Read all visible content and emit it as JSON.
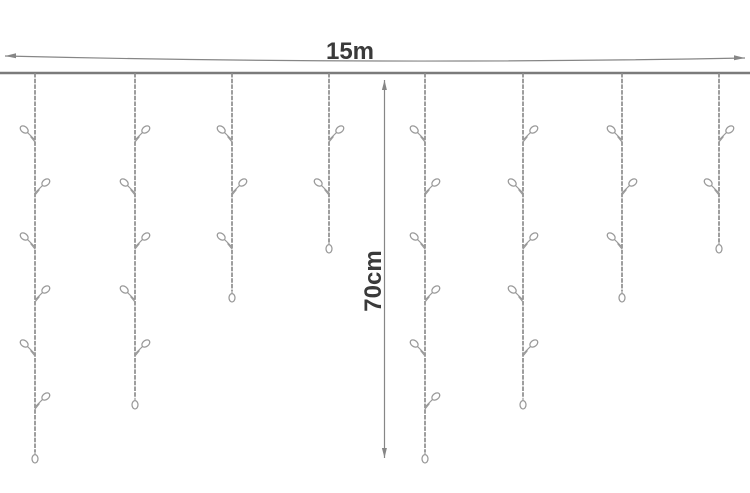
{
  "diagram": {
    "title": "icicle-string-lights-dimension-diagram",
    "background": "#ffffff",
    "labels": {
      "width": "15m",
      "drop": "70cm"
    },
    "colors": {
      "wire": "#7b7b7b",
      "strand": "#8d8d8d",
      "bulb_outline": "#999999",
      "bulb_fill": "#ffffff",
      "dimension_line": "#868686",
      "label_text": "#3a3a3a"
    },
    "geometry": {
      "canvas": {
        "width": 750,
        "height": 493
      },
      "wire": {
        "x1": 0,
        "x2": 750,
        "y": 73,
        "stroke_width": 2.4
      },
      "width_dimension": {
        "x1": 5,
        "x2": 745,
        "y_left": 56,
        "y_mid": 61,
        "y_right": 58,
        "label_x": 350,
        "label_y": 59,
        "font_size": 24
      },
      "drop_dimension": {
        "x": 384.5,
        "y1": 80,
        "y2": 458,
        "label_x": 381,
        "label_y": 281,
        "font_size": 24,
        "label_rotation": -90
      },
      "bulb_rows_y": [
        133,
        186,
        240,
        293,
        347,
        400
      ],
      "strands": [
        {
          "x": 35,
          "end_y": 452,
          "bulbs": [
            {
              "y": 133,
              "side": "left"
            },
            {
              "y": 186,
              "side": "right"
            },
            {
              "y": 240,
              "side": "left"
            },
            {
              "y": 293,
              "side": "right"
            },
            {
              "y": 347,
              "side": "left"
            },
            {
              "y": 400,
              "side": "right"
            }
          ]
        },
        {
          "x": 135,
          "end_y": 398,
          "bulbs": [
            {
              "y": 133,
              "side": "right"
            },
            {
              "y": 186,
              "side": "left"
            },
            {
              "y": 240,
              "side": "right"
            },
            {
              "y": 293,
              "side": "left"
            },
            {
              "y": 347,
              "side": "right"
            }
          ]
        },
        {
          "x": 232,
          "end_y": 291,
          "bulbs": [
            {
              "y": 133,
              "side": "left"
            },
            {
              "y": 186,
              "side": "right"
            },
            {
              "y": 240,
              "side": "left"
            }
          ]
        },
        {
          "x": 329,
          "end_y": 242,
          "bulbs": [
            {
              "y": 133,
              "side": "right"
            },
            {
              "y": 186,
              "side": "left"
            }
          ]
        },
        {
          "x": 425,
          "end_y": 452,
          "bulbs": [
            {
              "y": 133,
              "side": "left"
            },
            {
              "y": 186,
              "side": "right"
            },
            {
              "y": 240,
              "side": "left"
            },
            {
              "y": 293,
              "side": "right"
            },
            {
              "y": 347,
              "side": "left"
            },
            {
              "y": 400,
              "side": "right"
            }
          ]
        },
        {
          "x": 523,
          "end_y": 398,
          "bulbs": [
            {
              "y": 133,
              "side": "right"
            },
            {
              "y": 186,
              "side": "left"
            },
            {
              "y": 240,
              "side": "right"
            },
            {
              "y": 293,
              "side": "left"
            },
            {
              "y": 347,
              "side": "right"
            }
          ]
        },
        {
          "x": 622,
          "end_y": 291,
          "bulbs": [
            {
              "y": 133,
              "side": "left"
            },
            {
              "y": 186,
              "side": "right"
            },
            {
              "y": 240,
              "side": "left"
            }
          ]
        },
        {
          "x": 719,
          "end_y": 242,
          "bulbs": [
            {
              "y": 133,
              "side": "right"
            },
            {
              "y": 186,
              "side": "left"
            }
          ]
        }
      ]
    }
  }
}
